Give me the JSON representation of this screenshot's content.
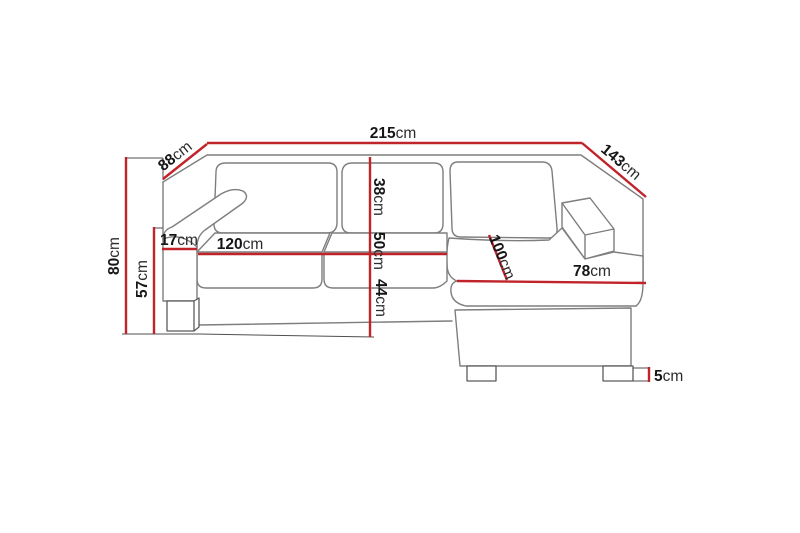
{
  "diagram": {
    "type": "furniture-dimension-diagram",
    "subject": "corner sofa with chaise longue",
    "unit": "cm",
    "colors": {
      "dimension_line": "#c0242a",
      "sofa_outline": "#7e7e7e",
      "extension_line": "#4f4f4f",
      "leg_outline": "#5a5a5a",
      "label_text": "#161616",
      "background": "#ffffff"
    },
    "dimensions": {
      "total_width": {
        "value": "215",
        "unit": "cm"
      },
      "back_depth": {
        "value": "88",
        "unit": "cm"
      },
      "chaise_side_depth": {
        "value": "143",
        "unit": "cm"
      },
      "total_height": {
        "value": "80",
        "unit": "cm"
      },
      "armrest_height": {
        "value": "57",
        "unit": "cm"
      },
      "armrest_width": {
        "value": "17",
        "unit": "cm"
      },
      "seat_width": {
        "value": "120",
        "unit": "cm"
      },
      "backrest_cushion_height": {
        "value": "38",
        "unit": "cm"
      },
      "seat_depth": {
        "value": "50",
        "unit": "cm"
      },
      "seat_height": {
        "value": "44",
        "unit": "cm"
      },
      "chaise_length": {
        "value": "100",
        "unit": "cm"
      },
      "chaise_width": {
        "value": "78",
        "unit": "cm"
      },
      "leg_height": {
        "value": "5",
        "unit": "cm"
      }
    }
  }
}
